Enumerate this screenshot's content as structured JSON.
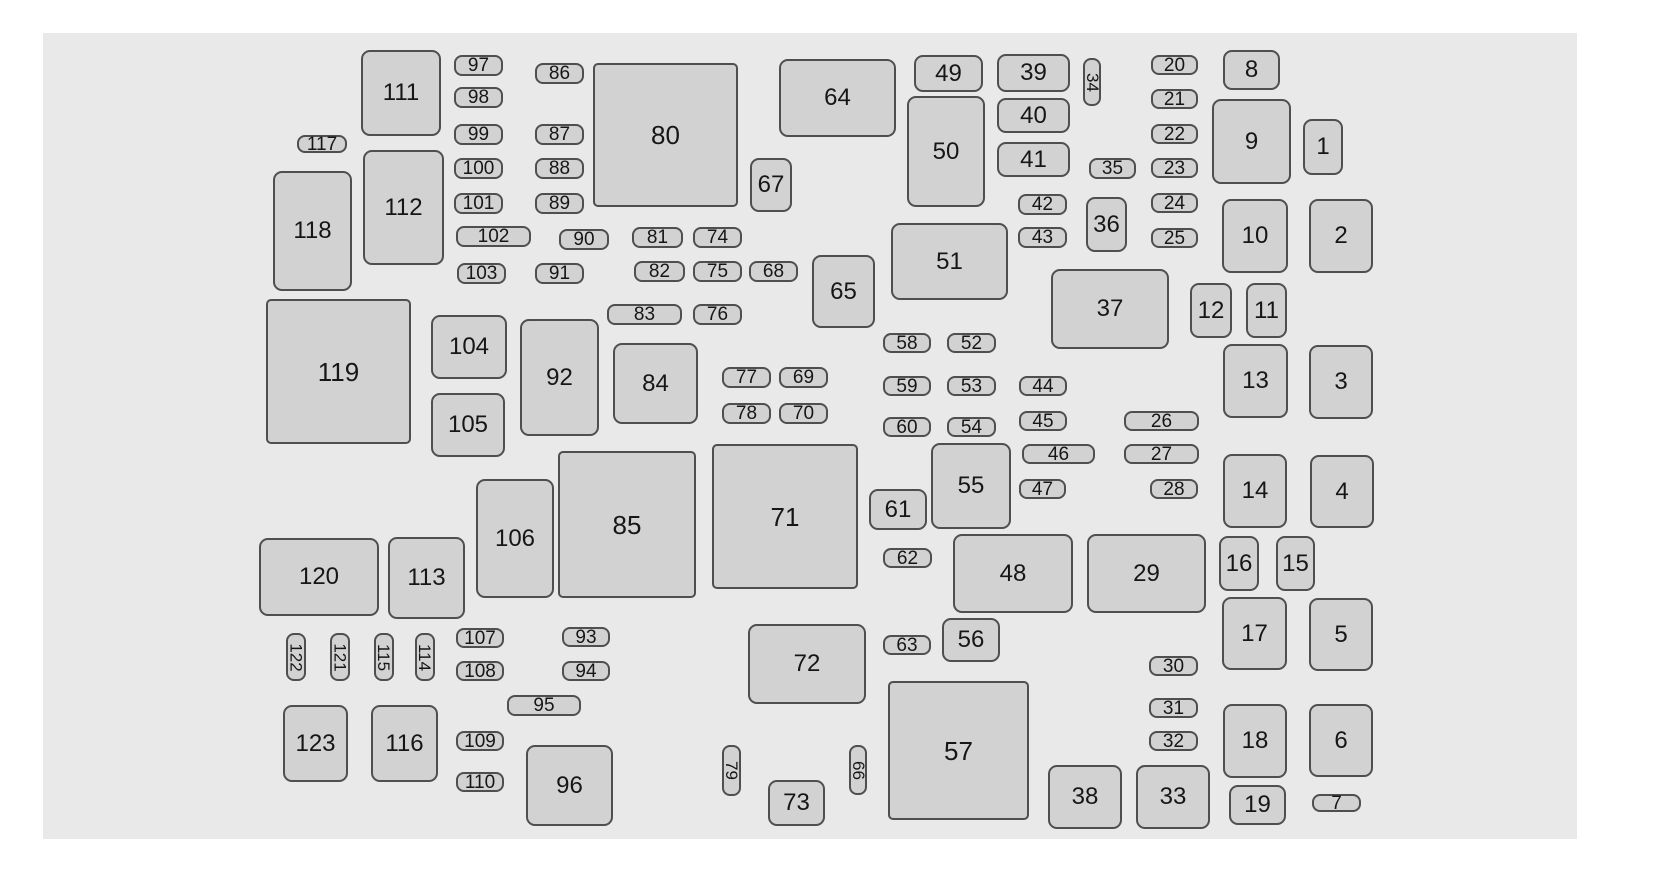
{
  "diagram": {
    "title": "fuse-box-layout",
    "colors": {
      "page": "#ffffff",
      "panel": "#e9e9e9",
      "shape_fill": "#d2d2d2",
      "shape_border": "#4f4f4f",
      "text": "#161616"
    },
    "panel": {
      "x": 43,
      "y": 33,
      "w": 1534,
      "h": 806
    },
    "items": [
      {
        "label": "1",
        "x": 1303,
        "y": 119,
        "w": 40,
        "h": 56,
        "shape": "box"
      },
      {
        "label": "2",
        "x": 1309,
        "y": 199,
        "w": 64,
        "h": 74,
        "shape": "box"
      },
      {
        "label": "3",
        "x": 1309,
        "y": 345,
        "w": 64,
        "h": 74,
        "shape": "box"
      },
      {
        "label": "4",
        "x": 1310,
        "y": 455,
        "w": 64,
        "h": 73,
        "shape": "box"
      },
      {
        "label": "5",
        "x": 1309,
        "y": 598,
        "w": 64,
        "h": 73,
        "shape": "box"
      },
      {
        "label": "6",
        "x": 1309,
        "y": 704,
        "w": 64,
        "h": 73,
        "shape": "box"
      },
      {
        "label": "7",
        "x": 1312,
        "y": 794,
        "w": 49,
        "h": 18,
        "shape": "pill"
      },
      {
        "label": "8",
        "x": 1223,
        "y": 50,
        "w": 57,
        "h": 40,
        "shape": "box"
      },
      {
        "label": "9",
        "x": 1212,
        "y": 99,
        "w": 79,
        "h": 85,
        "shape": "box"
      },
      {
        "label": "10",
        "x": 1222,
        "y": 199,
        "w": 66,
        "h": 74,
        "shape": "box"
      },
      {
        "label": "11",
        "x": 1246,
        "y": 283,
        "w": 41,
        "h": 55,
        "shape": "box"
      },
      {
        "label": "12",
        "x": 1190,
        "y": 283,
        "w": 42,
        "h": 55,
        "shape": "box"
      },
      {
        "label": "13",
        "x": 1223,
        "y": 344,
        "w": 65,
        "h": 74,
        "shape": "box"
      },
      {
        "label": "14",
        "x": 1223,
        "y": 454,
        "w": 64,
        "h": 74,
        "shape": "box"
      },
      {
        "label": "15",
        "x": 1276,
        "y": 536,
        "w": 39,
        "h": 55,
        "shape": "box"
      },
      {
        "label": "16",
        "x": 1219,
        "y": 536,
        "w": 40,
        "h": 55,
        "shape": "box"
      },
      {
        "label": "17",
        "x": 1222,
        "y": 597,
        "w": 65,
        "h": 73,
        "shape": "box"
      },
      {
        "label": "18",
        "x": 1223,
        "y": 704,
        "w": 64,
        "h": 74,
        "shape": "box"
      },
      {
        "label": "19",
        "x": 1229,
        "y": 785,
        "w": 57,
        "h": 40,
        "shape": "box"
      },
      {
        "label": "20",
        "x": 1151,
        "y": 55,
        "w": 47,
        "h": 20,
        "shape": "pill"
      },
      {
        "label": "21",
        "x": 1151,
        "y": 89,
        "w": 47,
        "h": 20,
        "shape": "pill"
      },
      {
        "label": "22",
        "x": 1151,
        "y": 124,
        "w": 47,
        "h": 20,
        "shape": "pill"
      },
      {
        "label": "23",
        "x": 1151,
        "y": 158,
        "w": 47,
        "h": 20,
        "shape": "pill"
      },
      {
        "label": "24",
        "x": 1151,
        "y": 193,
        "w": 47,
        "h": 20,
        "shape": "pill"
      },
      {
        "label": "25",
        "x": 1151,
        "y": 228,
        "w": 47,
        "h": 20,
        "shape": "pill"
      },
      {
        "label": "26",
        "x": 1124,
        "y": 411,
        "w": 75,
        "h": 20,
        "shape": "pill"
      },
      {
        "label": "27",
        "x": 1124,
        "y": 444,
        "w": 75,
        "h": 20,
        "shape": "pill"
      },
      {
        "label": "28",
        "x": 1150,
        "y": 479,
        "w": 48,
        "h": 20,
        "shape": "pill"
      },
      {
        "label": "29",
        "x": 1087,
        "y": 534,
        "w": 119,
        "h": 79,
        "shape": "box"
      },
      {
        "label": "30",
        "x": 1149,
        "y": 656,
        "w": 49,
        "h": 20,
        "shape": "pill"
      },
      {
        "label": "31",
        "x": 1149,
        "y": 698,
        "w": 49,
        "h": 20,
        "shape": "pill"
      },
      {
        "label": "32",
        "x": 1149,
        "y": 731,
        "w": 49,
        "h": 20,
        "shape": "pill"
      },
      {
        "label": "33",
        "x": 1136,
        "y": 765,
        "w": 74,
        "h": 64,
        "shape": "box"
      },
      {
        "label": "34",
        "x": 1083,
        "y": 58,
        "w": 18,
        "h": 48,
        "shape": "vpill"
      },
      {
        "label": "35",
        "x": 1089,
        "y": 158,
        "w": 47,
        "h": 21,
        "shape": "pill"
      },
      {
        "label": "36",
        "x": 1086,
        "y": 197,
        "w": 41,
        "h": 55,
        "shape": "box"
      },
      {
        "label": "37",
        "x": 1051,
        "y": 269,
        "w": 118,
        "h": 80,
        "shape": "box"
      },
      {
        "label": "38",
        "x": 1048,
        "y": 765,
        "w": 74,
        "h": 64,
        "shape": "box"
      },
      {
        "label": "39",
        "x": 997,
        "y": 54,
        "w": 73,
        "h": 38,
        "shape": "box"
      },
      {
        "label": "40",
        "x": 997,
        "y": 98,
        "w": 73,
        "h": 35,
        "shape": "box"
      },
      {
        "label": "41",
        "x": 997,
        "y": 142,
        "w": 73,
        "h": 35,
        "shape": "box"
      },
      {
        "label": "42",
        "x": 1018,
        "y": 194,
        "w": 49,
        "h": 21,
        "shape": "pill"
      },
      {
        "label": "43",
        "x": 1018,
        "y": 227,
        "w": 49,
        "h": 21,
        "shape": "pill"
      },
      {
        "label": "44",
        "x": 1019,
        "y": 376,
        "w": 48,
        "h": 20,
        "shape": "pill"
      },
      {
        "label": "45",
        "x": 1019,
        "y": 411,
        "w": 48,
        "h": 20,
        "shape": "pill"
      },
      {
        "label": "46",
        "x": 1022,
        "y": 444,
        "w": 73,
        "h": 20,
        "shape": "pill"
      },
      {
        "label": "47",
        "x": 1019,
        "y": 479,
        "w": 47,
        "h": 20,
        "shape": "pill"
      },
      {
        "label": "48",
        "x": 953,
        "y": 534,
        "w": 120,
        "h": 79,
        "shape": "box"
      },
      {
        "label": "49",
        "x": 914,
        "y": 55,
        "w": 69,
        "h": 37,
        "shape": "box"
      },
      {
        "label": "50",
        "x": 907,
        "y": 96,
        "w": 78,
        "h": 111,
        "shape": "box"
      },
      {
        "label": "51",
        "x": 891,
        "y": 223,
        "w": 117,
        "h": 77,
        "shape": "box"
      },
      {
        "label": "52",
        "x": 947,
        "y": 333,
        "w": 49,
        "h": 20,
        "shape": "pill"
      },
      {
        "label": "53",
        "x": 947,
        "y": 376,
        "w": 49,
        "h": 20,
        "shape": "pill"
      },
      {
        "label": "54",
        "x": 947,
        "y": 417,
        "w": 49,
        "h": 20,
        "shape": "pill"
      },
      {
        "label": "55",
        "x": 931,
        "y": 443,
        "w": 80,
        "h": 86,
        "shape": "box"
      },
      {
        "label": "56",
        "x": 942,
        "y": 618,
        "w": 58,
        "h": 44,
        "shape": "box"
      },
      {
        "label": "57",
        "x": 888,
        "y": 681,
        "w": 141,
        "h": 139,
        "shape": "bigbox"
      },
      {
        "label": "58",
        "x": 883,
        "y": 333,
        "w": 48,
        "h": 20,
        "shape": "pill"
      },
      {
        "label": "59",
        "x": 883,
        "y": 376,
        "w": 48,
        "h": 20,
        "shape": "pill"
      },
      {
        "label": "60",
        "x": 883,
        "y": 417,
        "w": 48,
        "h": 20,
        "shape": "pill"
      },
      {
        "label": "61",
        "x": 869,
        "y": 489,
        "w": 58,
        "h": 41,
        "shape": "box"
      },
      {
        "label": "62",
        "x": 883,
        "y": 548,
        "w": 49,
        "h": 20,
        "shape": "pill"
      },
      {
        "label": "63",
        "x": 883,
        "y": 635,
        "w": 48,
        "h": 20,
        "shape": "pill"
      },
      {
        "label": "64",
        "x": 779,
        "y": 59,
        "w": 117,
        "h": 78,
        "shape": "box"
      },
      {
        "label": "65",
        "x": 812,
        "y": 255,
        "w": 63,
        "h": 73,
        "shape": "box"
      },
      {
        "label": "66",
        "x": 849,
        "y": 745,
        "w": 18,
        "h": 50,
        "shape": "vpill"
      },
      {
        "label": "67",
        "x": 750,
        "y": 158,
        "w": 42,
        "h": 54,
        "shape": "box"
      },
      {
        "label": "68",
        "x": 749,
        "y": 261,
        "w": 49,
        "h": 21,
        "shape": "pill"
      },
      {
        "label": "69",
        "x": 779,
        "y": 367,
        "w": 49,
        "h": 21,
        "shape": "pill"
      },
      {
        "label": "70",
        "x": 779,
        "y": 403,
        "w": 49,
        "h": 21,
        "shape": "pill"
      },
      {
        "label": "71",
        "x": 712,
        "y": 444,
        "w": 146,
        "h": 145,
        "shape": "bigbox"
      },
      {
        "label": "72",
        "x": 748,
        "y": 624,
        "w": 118,
        "h": 80,
        "shape": "box"
      },
      {
        "label": "73",
        "x": 768,
        "y": 780,
        "w": 57,
        "h": 46,
        "shape": "box"
      },
      {
        "label": "74",
        "x": 693,
        "y": 227,
        "w": 49,
        "h": 21,
        "shape": "pill"
      },
      {
        "label": "75",
        "x": 693,
        "y": 261,
        "w": 49,
        "h": 21,
        "shape": "pill"
      },
      {
        "label": "76",
        "x": 693,
        "y": 304,
        "w": 49,
        "h": 21,
        "shape": "pill"
      },
      {
        "label": "77",
        "x": 722,
        "y": 367,
        "w": 49,
        "h": 21,
        "shape": "pill"
      },
      {
        "label": "78",
        "x": 722,
        "y": 403,
        "w": 49,
        "h": 21,
        "shape": "pill"
      },
      {
        "label": "79",
        "x": 722,
        "y": 745,
        "w": 19,
        "h": 51,
        "shape": "vpill"
      },
      {
        "label": "80",
        "x": 593,
        "y": 63,
        "w": 145,
        "h": 144,
        "shape": "bigbox"
      },
      {
        "label": "81",
        "x": 632,
        "y": 227,
        "w": 51,
        "h": 21,
        "shape": "pill"
      },
      {
        "label": "82",
        "x": 634,
        "y": 261,
        "w": 51,
        "h": 21,
        "shape": "pill"
      },
      {
        "label": "83",
        "x": 607,
        "y": 304,
        "w": 75,
        "h": 21,
        "shape": "pill"
      },
      {
        "label": "84",
        "x": 613,
        "y": 343,
        "w": 85,
        "h": 81,
        "shape": "box"
      },
      {
        "label": "85",
        "x": 558,
        "y": 451,
        "w": 138,
        "h": 147,
        "shape": "bigbox"
      },
      {
        "label": "86",
        "x": 535,
        "y": 63,
        "w": 49,
        "h": 21,
        "shape": "pill"
      },
      {
        "label": "87",
        "x": 535,
        "y": 124,
        "w": 49,
        "h": 21,
        "shape": "pill"
      },
      {
        "label": "88",
        "x": 535,
        "y": 158,
        "w": 49,
        "h": 21,
        "shape": "pill"
      },
      {
        "label": "89",
        "x": 535,
        "y": 193,
        "w": 49,
        "h": 21,
        "shape": "pill"
      },
      {
        "label": "90",
        "x": 559,
        "y": 229,
        "w": 50,
        "h": 21,
        "shape": "pill"
      },
      {
        "label": "91",
        "x": 535,
        "y": 263,
        "w": 49,
        "h": 21,
        "shape": "pill"
      },
      {
        "label": "92",
        "x": 520,
        "y": 319,
        "w": 79,
        "h": 117,
        "shape": "box"
      },
      {
        "label": "93",
        "x": 562,
        "y": 627,
        "w": 48,
        "h": 20,
        "shape": "pill"
      },
      {
        "label": "94",
        "x": 562,
        "y": 661,
        "w": 48,
        "h": 20,
        "shape": "pill"
      },
      {
        "label": "95",
        "x": 507,
        "y": 695,
        "w": 74,
        "h": 21,
        "shape": "pill"
      },
      {
        "label": "96",
        "x": 526,
        "y": 745,
        "w": 87,
        "h": 81,
        "shape": "box"
      },
      {
        "label": "97",
        "x": 454,
        "y": 55,
        "w": 49,
        "h": 21,
        "shape": "pill"
      },
      {
        "label": "98",
        "x": 454,
        "y": 87,
        "w": 49,
        "h": 21,
        "shape": "pill"
      },
      {
        "label": "99",
        "x": 454,
        "y": 124,
        "w": 49,
        "h": 21,
        "shape": "pill"
      },
      {
        "label": "100",
        "x": 454,
        "y": 158,
        "w": 49,
        "h": 21,
        "shape": "pill"
      },
      {
        "label": "101",
        "x": 454,
        "y": 193,
        "w": 49,
        "h": 21,
        "shape": "pill"
      },
      {
        "label": "102",
        "x": 456,
        "y": 226,
        "w": 75,
        "h": 21,
        "shape": "pill"
      },
      {
        "label": "103",
        "x": 457,
        "y": 263,
        "w": 49,
        "h": 21,
        "shape": "pill"
      },
      {
        "label": "104",
        "x": 431,
        "y": 315,
        "w": 76,
        "h": 64,
        "shape": "box"
      },
      {
        "label": "105",
        "x": 431,
        "y": 393,
        "w": 74,
        "h": 64,
        "shape": "box"
      },
      {
        "label": "106",
        "x": 476,
        "y": 479,
        "w": 78,
        "h": 119,
        "shape": "box"
      },
      {
        "label": "107",
        "x": 456,
        "y": 628,
        "w": 48,
        "h": 20,
        "shape": "pill"
      },
      {
        "label": "108",
        "x": 456,
        "y": 661,
        "w": 48,
        "h": 20,
        "shape": "pill"
      },
      {
        "label": "109",
        "x": 456,
        "y": 731,
        "w": 48,
        "h": 20,
        "shape": "pill"
      },
      {
        "label": "110",
        "x": 456,
        "y": 772,
        "w": 48,
        "h": 20,
        "shape": "pill"
      },
      {
        "label": "111",
        "x": 361,
        "y": 50,
        "w": 80,
        "h": 86,
        "shape": "box"
      },
      {
        "label": "112",
        "x": 363,
        "y": 150,
        "w": 81,
        "h": 115,
        "shape": "box"
      },
      {
        "label": "113",
        "x": 388,
        "y": 537,
        "w": 77,
        "h": 82,
        "shape": "box"
      },
      {
        "label": "114",
        "x": 415,
        "y": 633,
        "w": 20,
        "h": 48,
        "shape": "vpill"
      },
      {
        "label": "115",
        "x": 374,
        "y": 633,
        "w": 20,
        "h": 48,
        "shape": "vpill"
      },
      {
        "label": "116",
        "x": 371,
        "y": 705,
        "w": 67,
        "h": 77,
        "shape": "box"
      },
      {
        "label": "117",
        "x": 297,
        "y": 135,
        "w": 50,
        "h": 18,
        "shape": "pill"
      },
      {
        "label": "118",
        "x": 273,
        "y": 171,
        "w": 79,
        "h": 120,
        "shape": "box"
      },
      {
        "label": "119",
        "x": 266,
        "y": 299,
        "w": 145,
        "h": 145,
        "shape": "bigbox"
      },
      {
        "label": "120",
        "x": 259,
        "y": 538,
        "w": 120,
        "h": 78,
        "shape": "box"
      },
      {
        "label": "121",
        "x": 330,
        "y": 633,
        "w": 20,
        "h": 48,
        "shape": "vpill"
      },
      {
        "label": "122",
        "x": 286,
        "y": 633,
        "w": 20,
        "h": 48,
        "shape": "vpill"
      },
      {
        "label": "123",
        "x": 283,
        "y": 705,
        "w": 65,
        "h": 77,
        "shape": "box"
      }
    ]
  }
}
